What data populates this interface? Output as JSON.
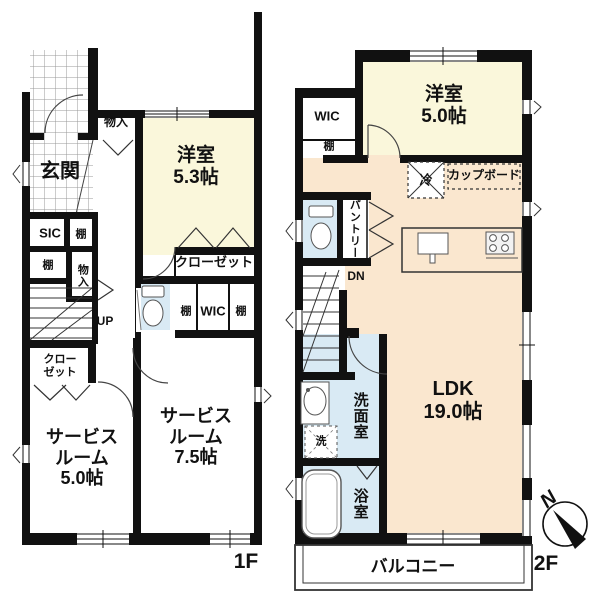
{
  "floor1": {
    "floor_label": "1F",
    "entrance": "玄関",
    "storage_top": "物入",
    "storage_side": "物入",
    "sic": "SIC",
    "shelf": "棚",
    "western_room": {
      "name": "洋室",
      "area": "5.3帖"
    },
    "closet": "クローゼット",
    "closet_lower": "クローゼット",
    "wic": "WIC",
    "stairs_up": "UP",
    "service_room_left": {
      "name": "サービスルーム",
      "area": "5.0帖"
    },
    "service_room_right": {
      "name": "サービスルーム",
      "area": "7.5帖"
    }
  },
  "floor2": {
    "floor_label": "2F",
    "wic": "WIC",
    "shelf": "棚",
    "western_room": {
      "name": "洋室",
      "area": "5.0帖"
    },
    "refrigerator": "冷",
    "cupboard": "カップボード",
    "pantry": "パントリー",
    "stairs_down": "DN",
    "ldk": {
      "name": "LDK",
      "area": "19.0帖"
    },
    "washroom": "洗面室",
    "washer": "洗",
    "bathroom": "浴室",
    "balcony": "バルコニー"
  },
  "compass": {
    "north": "N"
  },
  "colors": {
    "wall": "#111111",
    "western_room_fill": "#FAF7DB",
    "ldk_fill": "#FAE7CF",
    "wet_area_fill": "#D9EAF4",
    "tile_line": "#999999"
  }
}
